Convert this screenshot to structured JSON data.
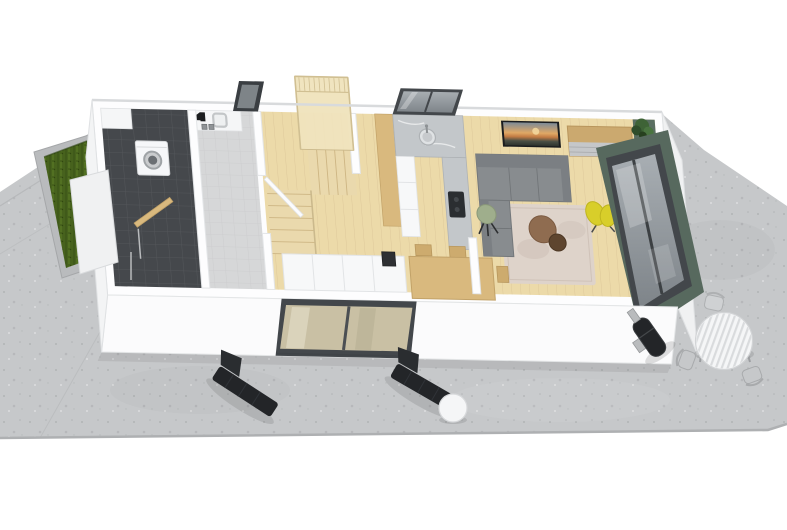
{
  "meta": {
    "kind": "3d-isometric-floor-plan-render",
    "description": "Bird's-eye 3D render of a single-storey apartment with surrounding concrete terrace"
  },
  "palette": {
    "background": "#ffffff",
    "terrace": "#c6c8ca",
    "terrace_seam": "#b4b6b8",
    "terrace_edge": "#aeb0b2",
    "planter_border": "#b9bbbd",
    "grass": "#47621d",
    "wall": "#fdfdfe",
    "wall_face": "#fbfbfc",
    "wall_face_left": "#f3f4f5",
    "wall_face_right": "#f0f1f2",
    "wall_edge": "#e2e4e6",
    "wood": "#ecdaa9",
    "stairs_wood": "#ead9ad",
    "landing_wood": "#efe3bd",
    "railing": "#d0bf92",
    "tile_dark": "#45484c",
    "bath_floor": "#d6d7d8",
    "marble": "#c3c7ca",
    "cabinet_white": "#f7f8f9",
    "glass": "#aab0b4",
    "frame_dark": "#43474b",
    "door_glass_wood": "#c9c0a4",
    "green_wall": "#5a6e62",
    "green_exterior": "#57695e",
    "sofa": "#888c8f",
    "sofa_dark": "#7b7f83",
    "rug": "#ded3ca",
    "dining_wood": "#d9b97e",
    "chair_wood": "#cdab6e",
    "sideboard_wood": "#cba96f",
    "drawer_face": "#c5c7c9",
    "tv_frame": "#1a1c1e",
    "plant_green": "#3e6336",
    "yellow_chair": "#d8ce2a",
    "stool_green": "#9fae8c",
    "coffee_table_big": "#8f6c50",
    "coffee_table_small": "#5e452f",
    "lounger_black": "#232528",
    "metal": "#b9bbbd",
    "patio_white": "#f5f6f7",
    "washer_white": "#f6f7f9",
    "recess_dark": "#3f4246"
  },
  "rooms": [
    {
      "name": "entry-utility",
      "floor": "anthracite-tile"
    },
    {
      "name": "bathroom",
      "floor": "light-screed"
    },
    {
      "name": "staircase",
      "floor": "light-wood"
    },
    {
      "name": "hallway-wardrobe",
      "floor": "light-wood"
    },
    {
      "name": "kitchen",
      "floor": "light-wood"
    },
    {
      "name": "living-dining-room",
      "floor": "light-wood"
    }
  ],
  "objects": {
    "washing_machine": {
      "label": "washing machine"
    },
    "bath_basin": {
      "label": "square basin with black faucet"
    },
    "staircase": {
      "label": "timber winder staircase with balustrade landing"
    },
    "wardrobe": {
      "label": "built-in white wardrobe"
    },
    "kitchen_sink": {
      "label": "round kitchen sink under window"
    },
    "cooktop": {
      "label": "black cooktop on peninsula"
    },
    "sofa": {
      "label": "grey corner sofa"
    },
    "tv_picture": {
      "label": "landscape picture / TV on wall"
    },
    "sideboard": {
      "label": "oak sideboard with grey drawers"
    },
    "plant": {
      "label": "potted plant"
    },
    "rug": {
      "label": "beige area rug"
    },
    "coffee_tables": {
      "label": "two round nesting coffee tables"
    },
    "yellow_armchair": {
      "label": "yellow petal armchair"
    },
    "green_stool": {
      "label": "green tripod stool"
    },
    "dining_set": {
      "label": "wooden dining table with chairs"
    },
    "sliding_door": {
      "label": "dark framed sliding glass door"
    },
    "corner_window": {
      "label": "large corner window in green accent wall"
    },
    "sun_loungers": {
      "label": "two black sun loungers"
    },
    "side_table": {
      "label": "white round side table"
    },
    "grill": {
      "label": "black pellet grill with chimney"
    },
    "patio_table": {
      "label": "white slatted round patio table with chairs"
    },
    "planter": {
      "label": "raised planter with grass"
    }
  }
}
